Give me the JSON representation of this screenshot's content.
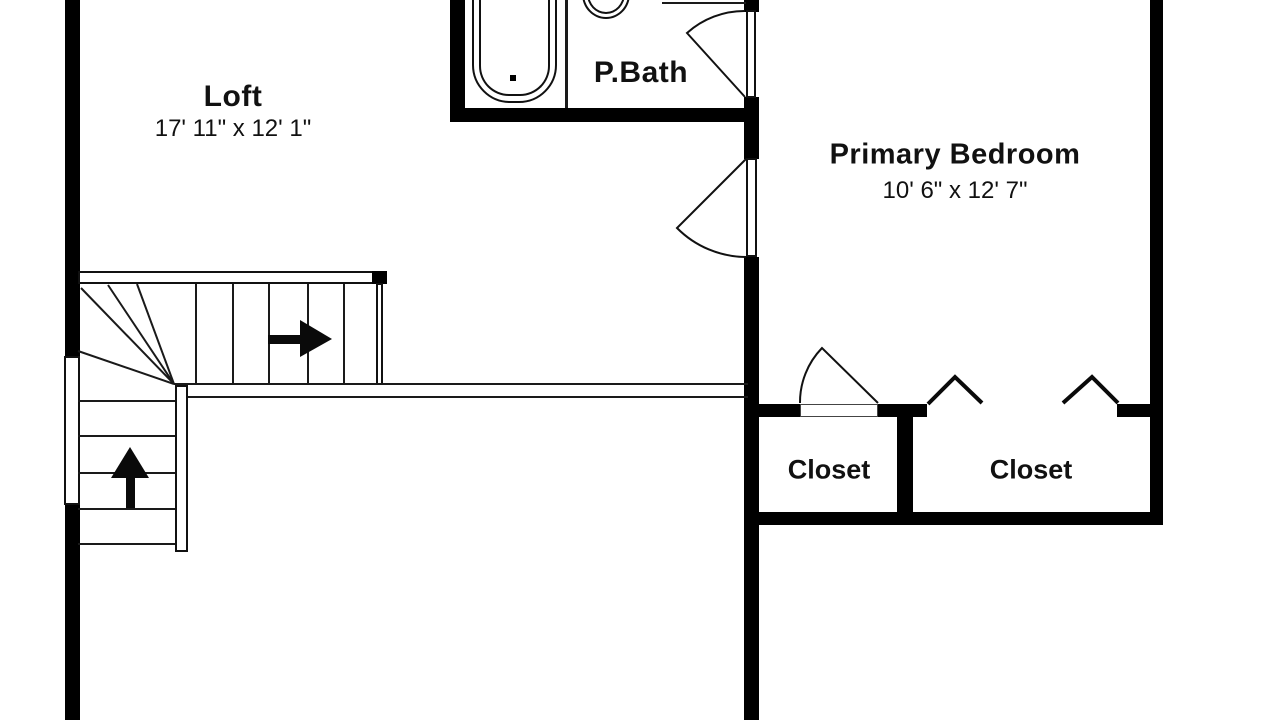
{
  "colors": {
    "wall": "#000000",
    "floor": "#ffffff",
    "line": "#1a1a1a",
    "text": "#111111"
  },
  "rooms": {
    "loft": {
      "label": "Loft",
      "dims": "17' 11\" x 12' 1\""
    },
    "pbath": {
      "label": "P.Bath"
    },
    "bedroom": {
      "label": "Primary Bedroom",
      "dims": "10' 6\" x 12' 7\""
    },
    "closet_small": {
      "label": "Closet"
    },
    "closet_large": {
      "label": "Closet"
    }
  },
  "icons": {
    "stairs_up_arrow": "up-direction-arrow",
    "stairs_right_arrow": "right-direction-arrow"
  }
}
